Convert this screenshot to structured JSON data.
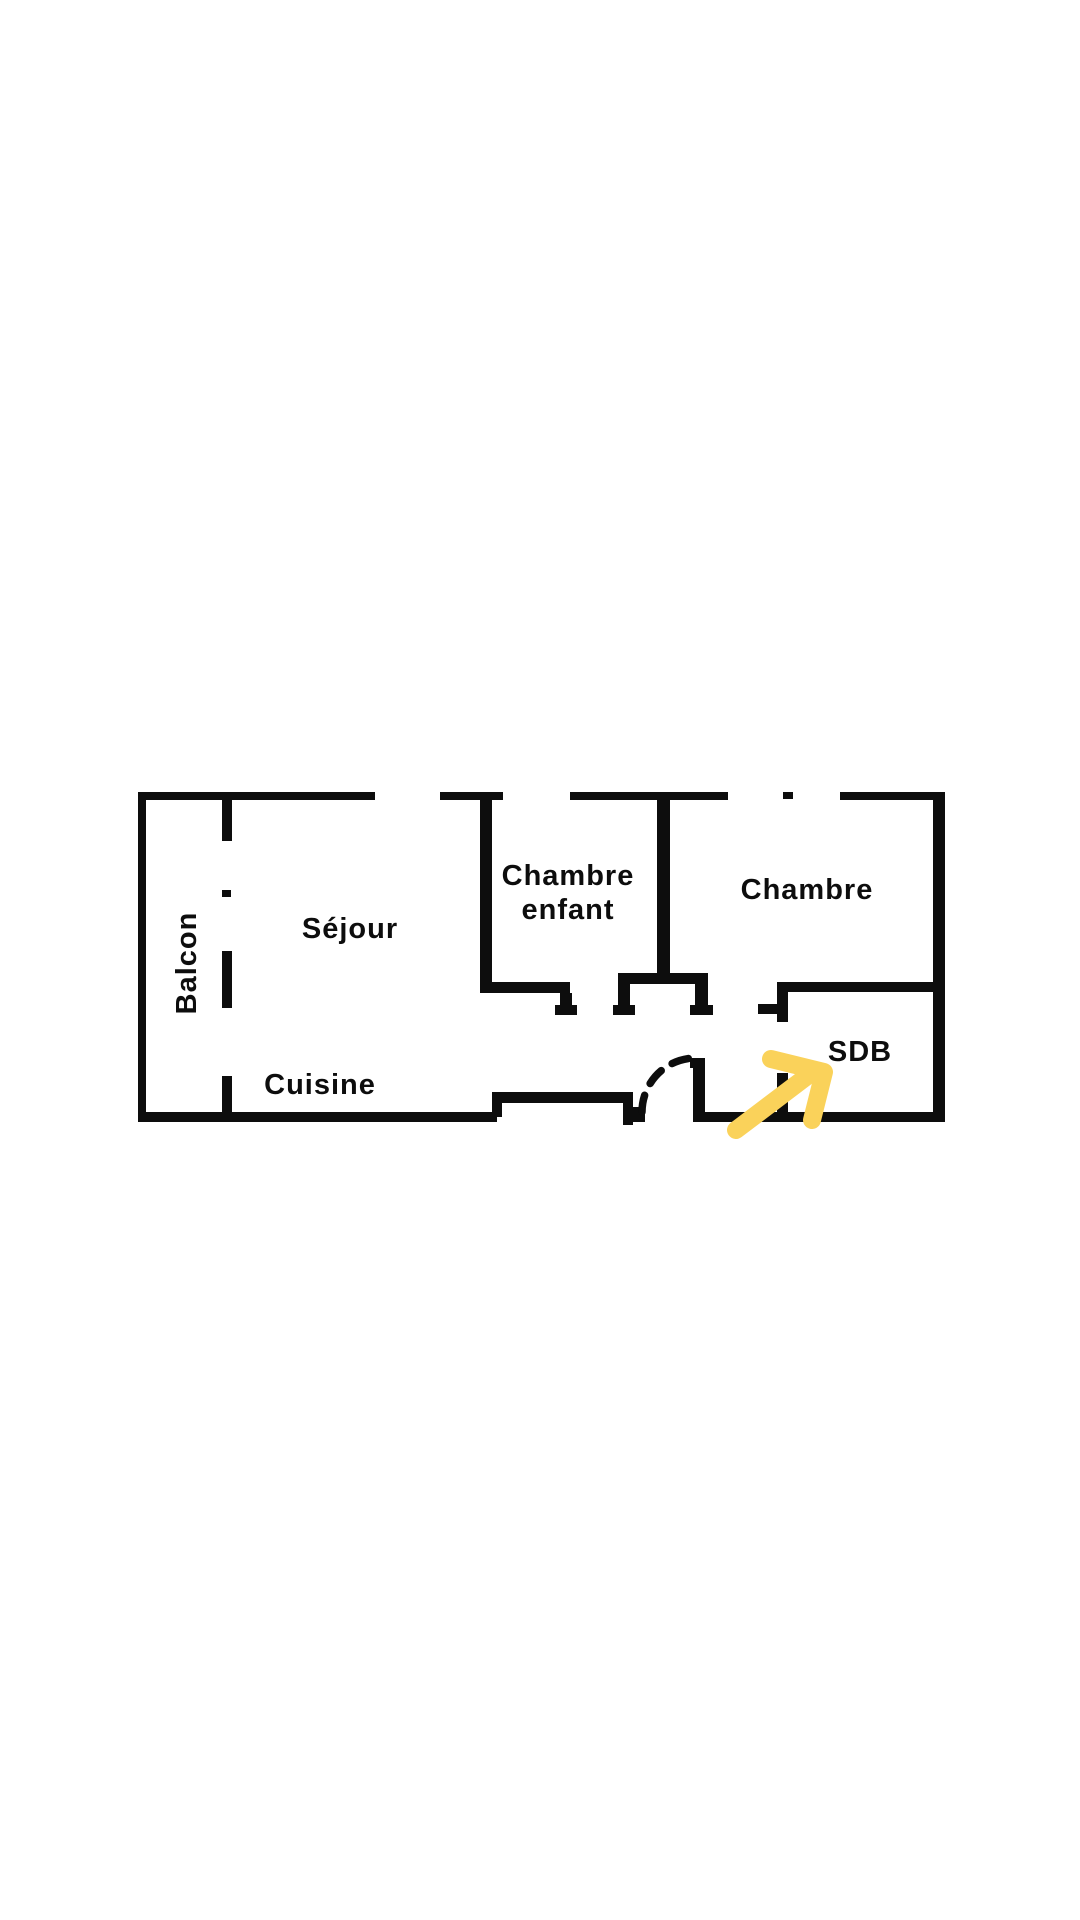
{
  "page": {
    "background": "#ffffff",
    "title": "Plan d'appartement"
  },
  "floorplan": {
    "type": "apartment-floor-plan",
    "colors": {
      "wall": "#0d0d0d",
      "label": "#0d0d0d",
      "arrow": "#FAD25A"
    },
    "rooms": [
      {
        "name": "Balcon"
      },
      {
        "name": "Séjour"
      },
      {
        "name": "Chambre enfant"
      },
      {
        "name": "Chambre"
      },
      {
        "name": "Cuisine"
      },
      {
        "name": "SDB"
      }
    ],
    "labels": {
      "balcon": "Balcon",
      "sejour": "Séjour",
      "chambre_enfant_l1": "Chambre",
      "chambre_enfant_l2": "enfant",
      "chambre": "Chambre",
      "cuisine": "Cuisine",
      "sdb": "SDB"
    },
    "annotation": {
      "kind": "hand-drawn-arrow",
      "points_to": "SDB"
    }
  }
}
